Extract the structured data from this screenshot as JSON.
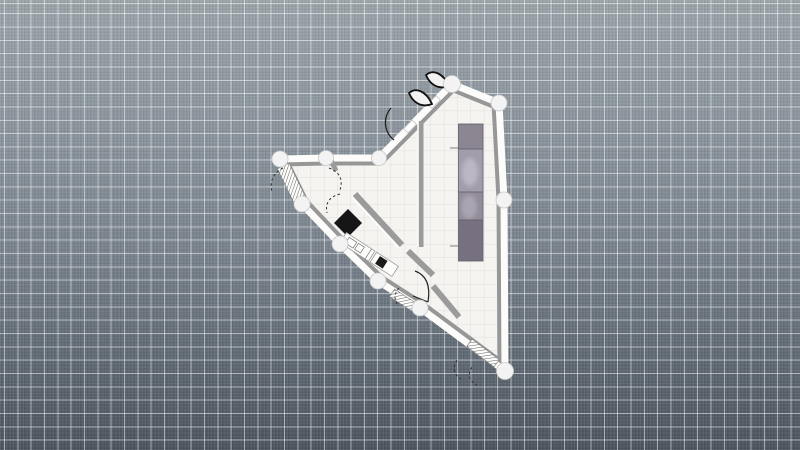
{
  "canvas": {
    "width": 800,
    "height": 450,
    "grid_spacing_px": 13.33,
    "colors": {
      "background_top": "#9aa3a9",
      "background_bottom": "#4b545e",
      "grid_line": "rgba(255,255,255,0.5)",
      "floor": "#f6f4f1",
      "wall": "#fcfcfb",
      "wall_shadow": "#979797",
      "node_fill": "#f3f3f3",
      "furniture_dark": "#161616",
      "appliance_gray": "#8b8692"
    }
  },
  "plan": {
    "outline": "280,159 326,158 379,158 452,84 499,103 504,200 505,371 420,308 378,281 340,244 302,204",
    "floor_grid_spacing": 13.33,
    "elements": [
      {
        "tag": "line",
        "name": "interior-wall",
        "interactable": true,
        "attrs": {
          "x1": 421,
          "y1": 121,
          "x2": 421,
          "y2": 247,
          "stroke": "#9b9b9b",
          "stroke-width": 5
        }
      },
      {
        "tag": "line",
        "name": "interior-wall-highlight",
        "interactable": false,
        "attrs": {
          "x1": 418,
          "y1": 121,
          "x2": 418,
          "y2": 247,
          "stroke": "#ffffff",
          "stroke-width": 1.6
        }
      },
      {
        "tag": "line",
        "name": "interior-wall",
        "interactable": true,
        "attrs": {
          "x1": 355,
          "y1": 194,
          "x2": 402,
          "y2": 245,
          "stroke": "#9b9b9b",
          "stroke-width": 6
        }
      },
      {
        "tag": "line",
        "name": "interior-wall-highlight",
        "interactable": false,
        "attrs": {
          "x1": 352,
          "y1": 197,
          "x2": 399,
          "y2": 248,
          "stroke": "#ffffff",
          "stroke-width": 1.6
        }
      },
      {
        "tag": "line",
        "name": "interior-wall",
        "interactable": true,
        "attrs": {
          "x1": 408,
          "y1": 251,
          "x2": 433,
          "y2": 275,
          "stroke": "#9b9b9b",
          "stroke-width": 6
        }
      },
      {
        "tag": "line",
        "name": "interior-wall",
        "interactable": true,
        "attrs": {
          "x1": 433,
          "y1": 286,
          "x2": 459,
          "y2": 317,
          "stroke": "#9b9b9b",
          "stroke-width": 6
        }
      },
      {
        "tag": "line",
        "name": "interior-wall-stub",
        "interactable": true,
        "attrs": {
          "x1": 331,
          "y1": 160,
          "x2": 336,
          "y2": 171,
          "stroke": "#9b9b9b",
          "stroke-width": 5
        }
      },
      {
        "tag": "rect",
        "name": "stairs",
        "interactable": true,
        "attrs": {
          "x": 285.5,
          "y": 164,
          "width": 13,
          "height": 40,
          "fill": "#fdfdfc",
          "stroke": "#8a8a8a",
          "stroke-width": 0.7,
          "transform": "rotate(-26 292 184)"
        }
      },
      {
        "tag": "rect",
        "name": "stairs-hatch",
        "interactable": false,
        "attrs": {
          "x": 285.5,
          "y": 164,
          "width": 13,
          "height": 40,
          "fill": "url(#hatch)",
          "transform": "rotate(-26 292 184)"
        }
      },
      {
        "tag": "rect",
        "name": "window-symbol",
        "interactable": true,
        "attrs": {
          "x": 390,
          "y": 295.5,
          "width": 26,
          "height": 9,
          "fill": "#fdfdfc",
          "stroke": "#8a8a8a",
          "stroke-width": 0.7,
          "transform": "rotate(33 403 300)"
        }
      },
      {
        "tag": "rect",
        "name": "window-symbol-hatch",
        "interactable": false,
        "attrs": {
          "x": 390,
          "y": 295.5,
          "width": 26,
          "height": 9,
          "fill": "url(#hatch)",
          "transform": "rotate(33 403 300)"
        }
      },
      {
        "tag": "rect",
        "name": "window-symbol",
        "interactable": true,
        "attrs": {
          "x": 466,
          "y": 348.5,
          "width": 34,
          "height": 9,
          "fill": "#fdfdfc",
          "stroke": "#8a8a8a",
          "stroke-width": 0.7,
          "transform": "rotate(37 483 353)"
        }
      },
      {
        "tag": "rect",
        "name": "window-symbol-hatch",
        "interactable": false,
        "attrs": {
          "x": 466,
          "y": 348.5,
          "width": 34,
          "height": 9,
          "fill": "url(#hatch)",
          "transform": "rotate(37 483 353)"
        }
      },
      {
        "tag": "rect",
        "name": "wardrobe-unit",
        "interactable": true,
        "attrs": {
          "x": 458.5,
          "y": 124,
          "width": 24.5,
          "height": 137,
          "fill": "#8b8692",
          "stroke": "#5e5965",
          "stroke-width": 0.8
        }
      },
      {
        "tag": "rect",
        "name": "wardrobe-segment",
        "interactable": false,
        "attrs": {
          "x": 458.9,
          "y": 149,
          "width": 23.7,
          "height": 43,
          "fill": "#a29daa"
        }
      },
      {
        "tag": "rect",
        "name": "wardrobe-segment",
        "interactable": false,
        "attrs": {
          "x": 458.9,
          "y": 192,
          "width": 23.7,
          "height": 28,
          "fill": "#918c98"
        }
      },
      {
        "tag": "rect",
        "name": "wardrobe-segment",
        "interactable": false,
        "attrs": {
          "x": 458.9,
          "y": 220,
          "width": 23.7,
          "height": 40.5,
          "fill": "#767080"
        }
      },
      {
        "tag": "ellipse",
        "name": "wardrobe-highlight",
        "interactable": false,
        "attrs": {
          "cx": 470,
          "cy": 172,
          "rx": 8,
          "ry": 14,
          "fill": "#d6d2de",
          "opacity": 0.5,
          "filter": "url(#soft)"
        }
      },
      {
        "tag": "ellipse",
        "name": "wardrobe-highlight",
        "interactable": false,
        "attrs": {
          "cx": 469,
          "cy": 207,
          "rx": 8,
          "ry": 12,
          "fill": "#cfcbd8",
          "opacity": 0.4,
          "filter": "url(#soft)"
        }
      },
      {
        "tag": "line",
        "name": "wardrobe-divider",
        "interactable": false,
        "attrs": {
          "x1": 458.5,
          "y1": 149,
          "x2": 483,
          "y2": 149,
          "stroke": "#5e5965",
          "stroke-width": 0.7
        }
      },
      {
        "tag": "line",
        "name": "wardrobe-divider",
        "interactable": false,
        "attrs": {
          "x1": 458.5,
          "y1": 192,
          "x2": 483,
          "y2": 192,
          "stroke": "#5e5965",
          "stroke-width": 0.7
        }
      },
      {
        "tag": "line",
        "name": "wardrobe-divider",
        "interactable": false,
        "attrs": {
          "x1": 458.5,
          "y1": 220,
          "x2": 483,
          "y2": 220,
          "stroke": "#5e5965",
          "stroke-width": 0.7
        }
      },
      {
        "tag": "line",
        "name": "wardrobe-tick",
        "interactable": false,
        "attrs": {
          "x1": 450,
          "y1": 148,
          "x2": 458,
          "y2": 148,
          "stroke": "#7d7d7d",
          "stroke-width": 1
        }
      },
      {
        "tag": "line",
        "name": "wardrobe-tick",
        "interactable": false,
        "attrs": {
          "x1": 450,
          "y1": 246,
          "x2": 458,
          "y2": 246,
          "stroke": "#7d7d7d",
          "stroke-width": 1
        }
      },
      {
        "tag": "polygon",
        "name": "table-diamond",
        "interactable": true,
        "attrs": {
          "points": "348,209 362,223 348,237 334,223",
          "fill": "#161616"
        }
      },
      {
        "tag": "rect",
        "name": "kitchen-counter",
        "interactable": true,
        "attrs": {
          "x": 338,
          "y": 249,
          "width": 34,
          "height": 12,
          "fill": "#fcfcfb",
          "stroke": "#9a9a9a",
          "stroke-width": 0.8,
          "transform": "rotate(33 370 255)"
        }
      },
      {
        "tag": "rect",
        "name": "kitchen-counter",
        "interactable": true,
        "attrs": {
          "x": 374,
          "y": 249,
          "width": 26,
          "height": 12,
          "fill": "#fcfcfb",
          "stroke": "#9a9a9a",
          "stroke-width": 0.8,
          "transform": "rotate(33 370 255)"
        }
      },
      {
        "tag": "rect",
        "name": "sink-basin",
        "interactable": true,
        "attrs": {
          "x": 343,
          "y": 251.5,
          "width": 9,
          "height": 7,
          "fill": "#ffffff",
          "stroke": "#777777",
          "stroke-width": 0.7,
          "transform": "rotate(33 370 255)"
        }
      },
      {
        "tag": "rect",
        "name": "sink-basin",
        "interactable": true,
        "attrs": {
          "x": 354,
          "y": 251.5,
          "width": 7,
          "height": 7,
          "fill": "#ffffff",
          "stroke": "#777777",
          "stroke-width": 0.7,
          "transform": "rotate(33 370 255)"
        }
      },
      {
        "tag": "rect",
        "name": "stove",
        "interactable": true,
        "attrs": {
          "x": 379,
          "y": 250.5,
          "width": 9,
          "height": 9,
          "fill": "#1c1c1c",
          "transform": "rotate(33 370 255)"
        }
      },
      {
        "tag": "line",
        "name": "counter-divider",
        "interactable": false,
        "attrs": {
          "x1": 368,
          "y1": 249,
          "x2": 368,
          "y2": 261,
          "stroke": "#777777",
          "stroke-width": 0.7,
          "transform": "rotate(33 370 255)"
        }
      },
      {
        "tag": "rect",
        "name": "door-jamb",
        "interactable": false,
        "attrs": {
          "x": 404,
          "y": 123.5,
          "width": 12,
          "height": 6,
          "fill": "#ffffff",
          "stroke": "#adadad",
          "stroke-width": 0.6,
          "transform": "rotate(135 410 126.5)"
        }
      },
      {
        "tag": "rect",
        "name": "door-jamb",
        "interactable": false,
        "attrs": {
          "x": 428,
          "y": 99,
          "width": 12,
          "height": 6,
          "fill": "#ffffff",
          "stroke": "#adadad",
          "stroke-width": 0.6,
          "transform": "rotate(135 434 102)"
        }
      },
      {
        "tag": "path",
        "name": "door-leaf",
        "interactable": true,
        "attrs": {
          "d": "M 449,86 C 443,73 433,69 426,75 C 430,85 439,90 449,86 Z",
          "fill": "#f2f2f2",
          "stroke": "#111111",
          "stroke-width": 1.8
        }
      },
      {
        "tag": "path",
        "name": "door-leaf",
        "interactable": true,
        "attrs": {
          "d": "M 432,104 C 426,91 416,87 409,93 C 413,103 422,108 432,104 Z",
          "fill": "#f2f2f2",
          "stroke": "#111111",
          "stroke-width": 1.8
        }
      },
      {
        "tag": "path",
        "name": "door-swing-arc",
        "interactable": true,
        "attrs": {
          "d": "M 394,140 A 22,22 0 0 1 391,108",
          "fill": "none",
          "stroke": "#222222",
          "stroke-width": 1.3
        }
      },
      {
        "tag": "path",
        "name": "door-swing-arc",
        "interactable": true,
        "attrs": {
          "d": "M 415,271 Q 432,277 428,302",
          "fill": "none",
          "stroke": "#222222",
          "stroke-width": 1.2
        }
      },
      {
        "tag": "path",
        "name": "door-leaf-line",
        "interactable": false,
        "attrs": {
          "d": "M 428,302 L 413,296",
          "fill": "none",
          "stroke": "#222222",
          "stroke-width": 1.2
        }
      },
      {
        "tag": "path",
        "name": "door-swing-dashed",
        "interactable": false,
        "attrs": {
          "d": "M 283,168 Q 268,176 272,192",
          "fill": "none",
          "stroke": "#333333",
          "stroke-width": 1,
          "stroke-dasharray": "2.5,2.5"
        }
      },
      {
        "tag": "path",
        "name": "door-swing-dashed",
        "interactable": false,
        "attrs": {
          "d": "M 329,168 Q 345,174 340,190",
          "fill": "none",
          "stroke": "#333333",
          "stroke-width": 1,
          "stroke-dasharray": "2.5,2.5"
        }
      },
      {
        "tag": "path",
        "name": "door-swing-dashed",
        "interactable": false,
        "attrs": {
          "d": "M 340,194 Q 324,198 327,213",
          "fill": "none",
          "stroke": "#333333",
          "stroke-width": 1,
          "stroke-dasharray": "2.5,2.5"
        }
      },
      {
        "tag": "path",
        "name": "door-swing-dashed",
        "interactable": false,
        "attrs": {
          "d": "M 399,288 Q 391,297 399,306",
          "fill": "none",
          "stroke": "#333333",
          "stroke-width": 1,
          "stroke-dasharray": "2.5,2.5"
        }
      },
      {
        "tag": "path",
        "name": "door-swing-dashed",
        "interactable": false,
        "attrs": {
          "d": "M 457,360 Q 450,372 461,379",
          "fill": "none",
          "stroke": "#333333",
          "stroke-width": 1,
          "stroke-dasharray": "2.5,2.5"
        }
      },
      {
        "tag": "path",
        "name": "door-swing-dashed",
        "interactable": false,
        "attrs": {
          "d": "M 472,367 Q 465,379 477,385",
          "fill": "none",
          "stroke": "#333333",
          "stroke-width": 1,
          "stroke-dasharray": "2.5,2.5"
        }
      },
      {
        "tag": "circle",
        "name": "wall-node",
        "interactable": true,
        "attrs": {
          "cx": 452,
          "cy": 84,
          "r": 8.5,
          "fill": "#f3f3f3",
          "stroke": "#c9c9c9",
          "stroke-width": 0.8
        }
      },
      {
        "tag": "circle",
        "name": "wall-node",
        "interactable": true,
        "attrs": {
          "cx": 499,
          "cy": 103,
          "r": 8,
          "fill": "#f3f3f3",
          "stroke": "#c9c9c9",
          "stroke-width": 0.8
        }
      },
      {
        "tag": "circle",
        "name": "wall-node",
        "interactable": true,
        "attrs": {
          "cx": 504,
          "cy": 200,
          "r": 8,
          "fill": "#f3f3f3",
          "stroke": "#c9c9c9",
          "stroke-width": 0.8
        }
      },
      {
        "tag": "circle",
        "name": "wall-node",
        "interactable": true,
        "attrs": {
          "cx": 505,
          "cy": 371,
          "r": 8.5,
          "fill": "#f3f3f3",
          "stroke": "#c9c9c9",
          "stroke-width": 0.8
        }
      },
      {
        "tag": "circle",
        "name": "wall-node",
        "interactable": true,
        "attrs": {
          "cx": 420,
          "cy": 308,
          "r": 8,
          "fill": "#f3f3f3",
          "stroke": "#c9c9c9",
          "stroke-width": 0.8
        }
      },
      {
        "tag": "circle",
        "name": "wall-node",
        "interactable": true,
        "attrs": {
          "cx": 378,
          "cy": 281,
          "r": 8,
          "fill": "#f3f3f3",
          "stroke": "#c9c9c9",
          "stroke-width": 0.8
        }
      },
      {
        "tag": "circle",
        "name": "wall-node",
        "interactable": true,
        "attrs": {
          "cx": 340,
          "cy": 244,
          "r": 8,
          "fill": "#f3f3f3",
          "stroke": "#c9c9c9",
          "stroke-width": 0.8
        }
      },
      {
        "tag": "circle",
        "name": "wall-node",
        "interactable": true,
        "attrs": {
          "cx": 302,
          "cy": 204,
          "r": 8,
          "fill": "#f3f3f3",
          "stroke": "#c9c9c9",
          "stroke-width": 0.8
        }
      },
      {
        "tag": "circle",
        "name": "wall-node",
        "interactable": true,
        "attrs": {
          "cx": 280,
          "cy": 159,
          "r": 8,
          "fill": "#f3f3f3",
          "stroke": "#c9c9c9",
          "stroke-width": 0.8
        }
      },
      {
        "tag": "circle",
        "name": "wall-node",
        "interactable": true,
        "attrs": {
          "cx": 326,
          "cy": 158,
          "r": 7.5,
          "fill": "#f3f3f3",
          "stroke": "#c9c9c9",
          "stroke-width": 0.8
        }
      },
      {
        "tag": "circle",
        "name": "wall-node",
        "interactable": true,
        "attrs": {
          "cx": 379,
          "cy": 158,
          "r": 7.5,
          "fill": "#f3f3f3",
          "stroke": "#c9c9c9",
          "stroke-width": 0.8
        }
      }
    ]
  }
}
